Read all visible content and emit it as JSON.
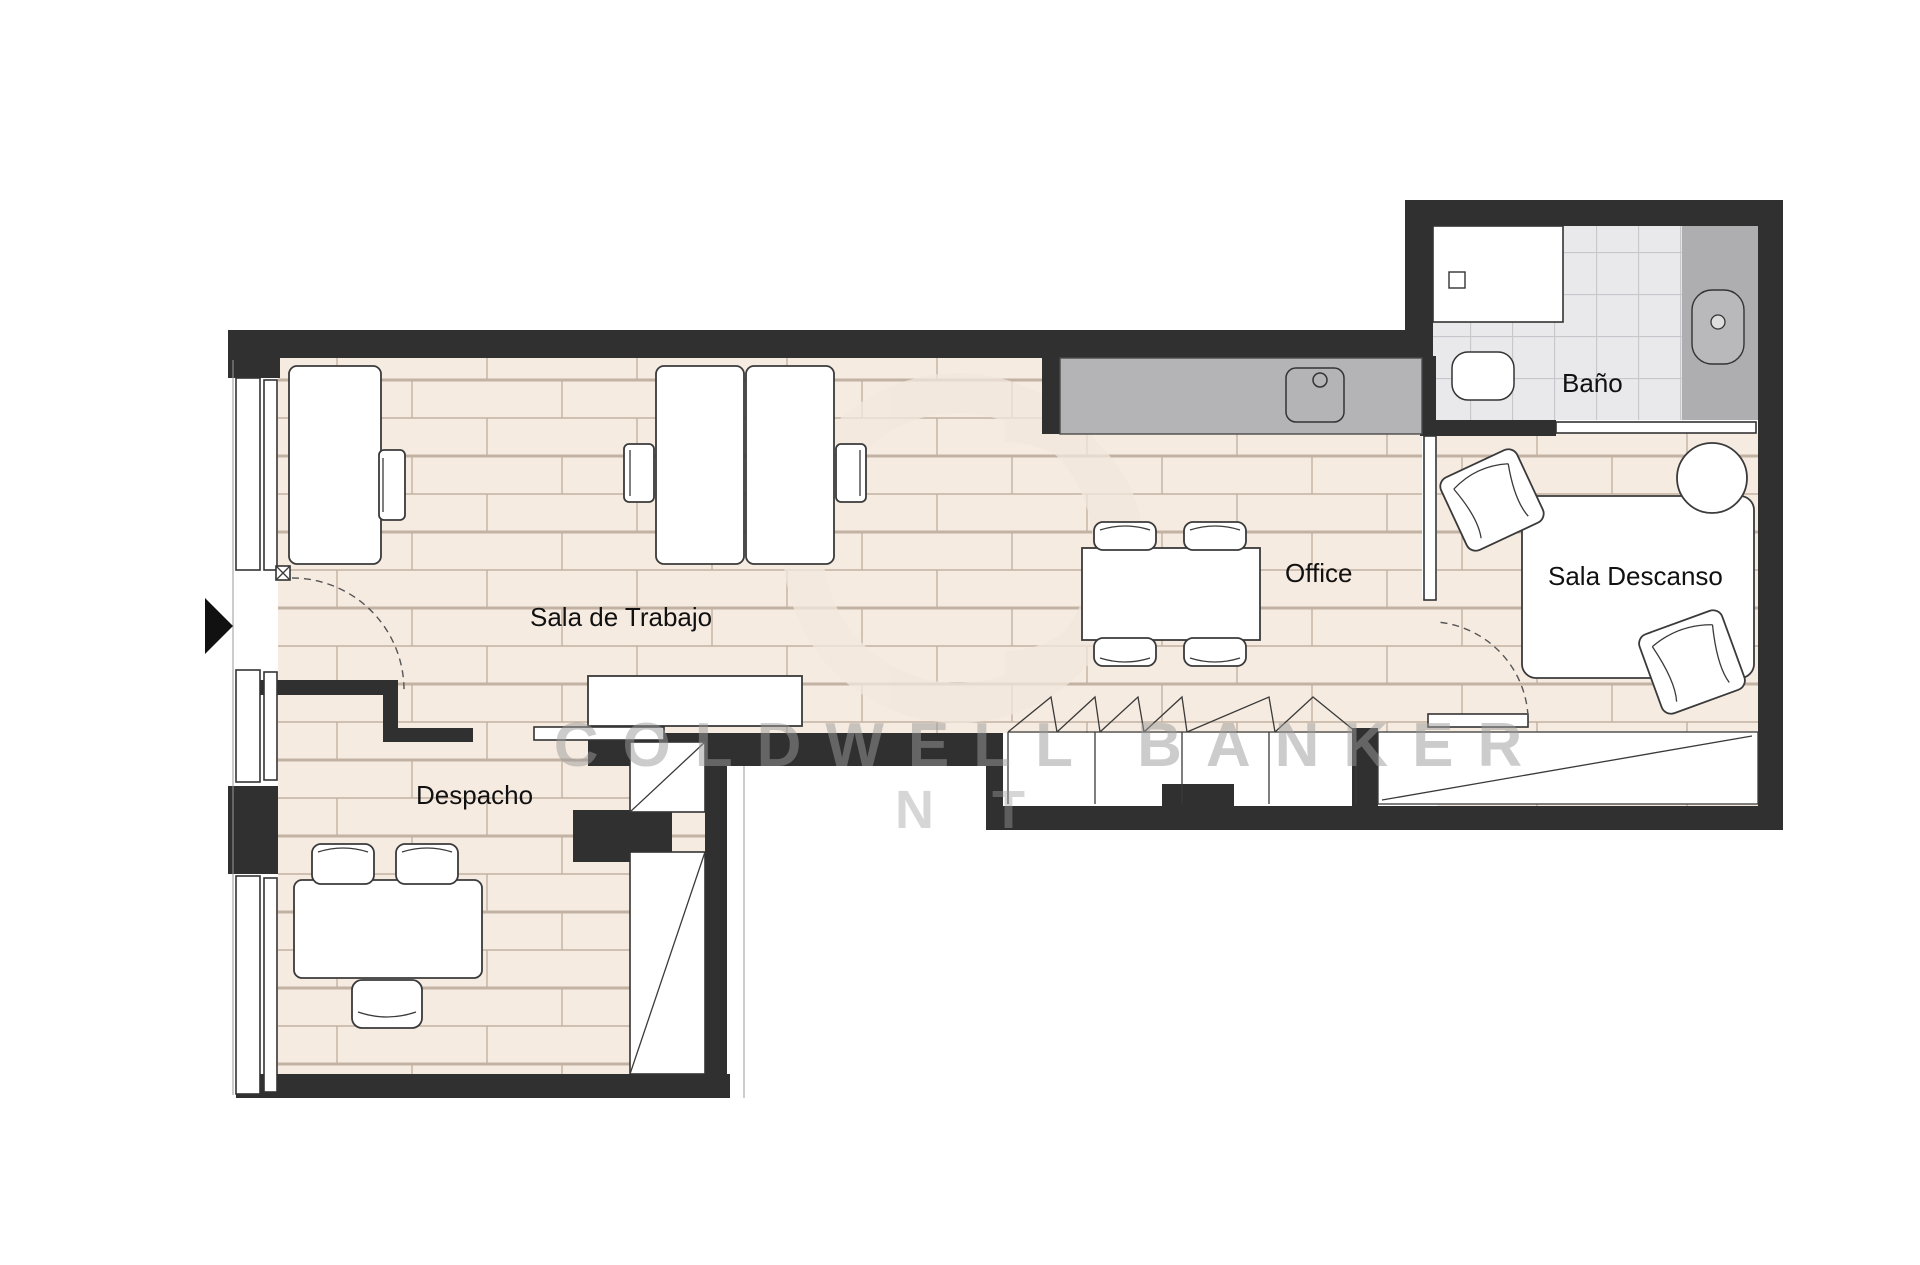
{
  "rooms": {
    "sala_de_trabajo": {
      "label": "Sala de Trabajo"
    },
    "despacho": {
      "label": "Despacho"
    },
    "office": {
      "label": "Office"
    },
    "bano": {
      "label": "Baño"
    },
    "sala_descanso": {
      "label": "Sala Descanso"
    }
  },
  "watermark": {
    "line1": "COLDWELL BANKER",
    "line2": "NT"
  },
  "colors": {
    "wall": "#303030",
    "floor_brick_fill": "#f6ebe1",
    "floor_brick_joint": "#c2b2a2",
    "bath_tile_fill": "#e9e9ec",
    "bath_tile_line": "#c7c7cb",
    "kitchen_counter_gray": "#b4b4b6",
    "vanity_gray": "#aeaeb0",
    "furniture_outline": "#3a3a3a",
    "watermark_gray": "#9b9b9b",
    "entry_arrow": "#111111"
  },
  "icons": {
    "entry_arrow": "entry-arrow-icon",
    "sink": "sink-icon",
    "shower": "shower-tray-icon",
    "toilet": "toilet-icon",
    "washbasin": "washbasin-icon"
  }
}
